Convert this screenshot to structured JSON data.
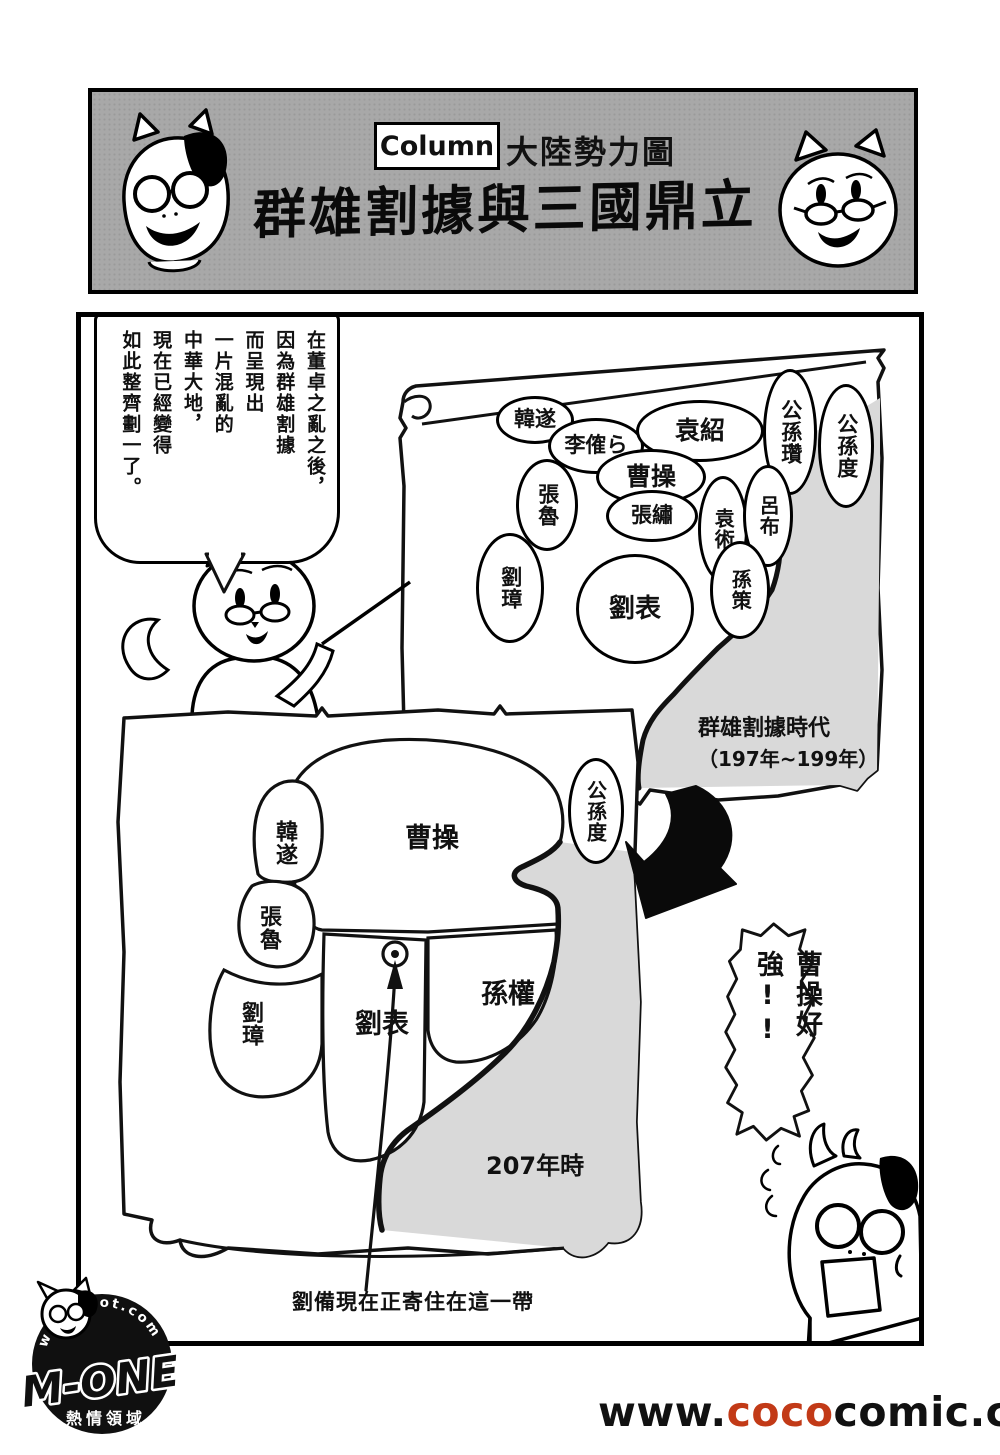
{
  "header": {
    "column_tag": "Column",
    "category": "大陸勢力圖",
    "title": "群雄割據與三國鼎立"
  },
  "speech": {
    "lines": [
      {
        "text": "在董卓之亂之後，"
      },
      {
        "text": "因為群雄割據"
      },
      {
        "text": "而呈現出"
      },
      {
        "text": "一片混亂的"
      },
      {
        "text": "中華大地，"
      },
      {
        "text": "現在已經變得"
      },
      {
        "text": "如此整齊劃一了。"
      }
    ]
  },
  "map1": {
    "era": {
      "line1": "群雄割據時代",
      "line2": "（197年~199年）"
    },
    "warlords": [
      {
        "label": "韓遂"
      },
      {
        "label": "李傕ら"
      },
      {
        "label": "袁紹"
      },
      {
        "label": "公孫瓚"
      },
      {
        "label": "公孫度"
      },
      {
        "label": "張魯"
      },
      {
        "label": "曹操"
      },
      {
        "label": "張繡"
      },
      {
        "label": "袁術"
      },
      {
        "label": "呂布"
      },
      {
        "label": "劉璋"
      },
      {
        "label": "劉表"
      },
      {
        "label": "孫策"
      }
    ]
  },
  "map2": {
    "territories": [
      {
        "label": "韓遂"
      },
      {
        "label": "張魯"
      },
      {
        "label": "劉璋"
      },
      {
        "label": "曹操"
      },
      {
        "label": "劉表"
      },
      {
        "label": "孫權"
      },
      {
        "label": "公孫度"
      }
    ],
    "year_label": "207年時",
    "note": "劉備現在正寄住在這一帶"
  },
  "exclaim": {
    "text": "曹操好強!!"
  },
  "logo": {
    "arc_text": "w.jojohot.com",
    "brand": "M-ONE",
    "tagline": "熱情領域"
  },
  "footer": {
    "url_prefix": "www.",
    "url_highlight": "coco",
    "url_suffix": "comic.com"
  },
  "colors": {
    "header_bg": "#a8a8a8",
    "sea": "#d9d9d9",
    "url_highlight": "#c23a17",
    "ink": "#111111"
  }
}
